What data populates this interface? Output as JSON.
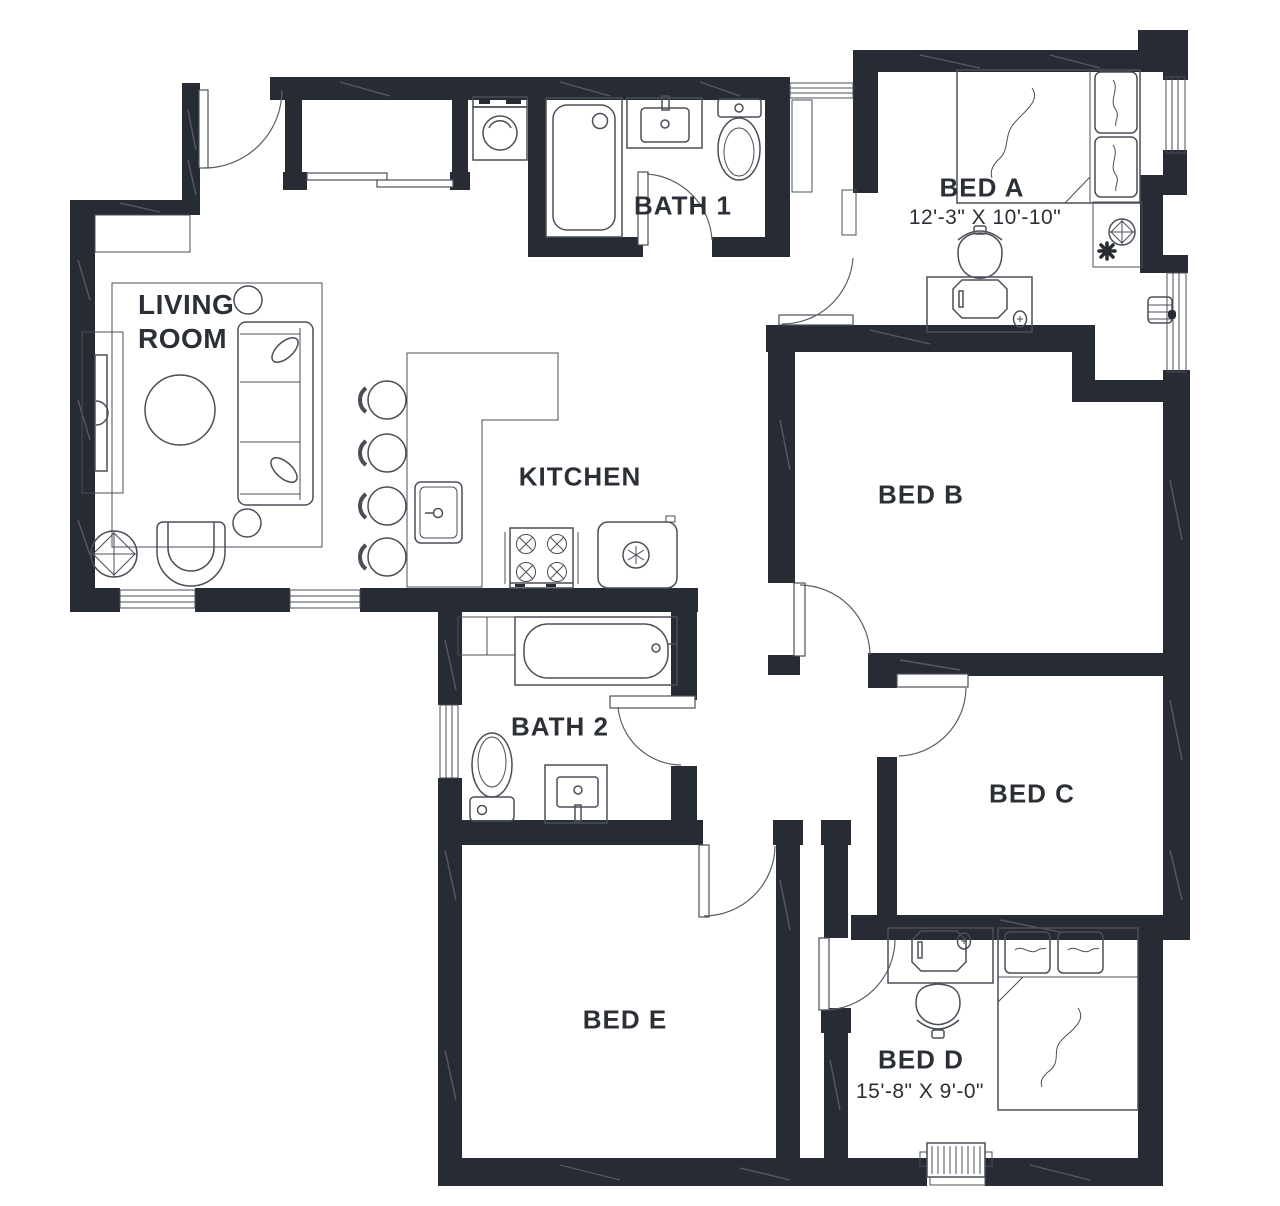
{
  "rooms": {
    "living_room": {
      "label_line1": "LIVING",
      "label_line2": "ROOM"
    },
    "kitchen": {
      "label": "KITCHEN"
    },
    "bath1": {
      "label": "BATH 1"
    },
    "bath2": {
      "label": "BATH 2"
    },
    "bed_a": {
      "label": "BED A",
      "dimensions": "12'-3\" X 10'-10\""
    },
    "bed_b": {
      "label": "BED B"
    },
    "bed_c": {
      "label": "BED C"
    },
    "bed_d": {
      "label": "BED D",
      "dimensions": "15'-8\" X 9'-0\""
    },
    "bed_e": {
      "label": "BED E"
    }
  },
  "colors": {
    "wall": "#272b33",
    "fixture_line": "#4a4f57",
    "text": "#2b2f36",
    "background": "#ffffff"
  }
}
